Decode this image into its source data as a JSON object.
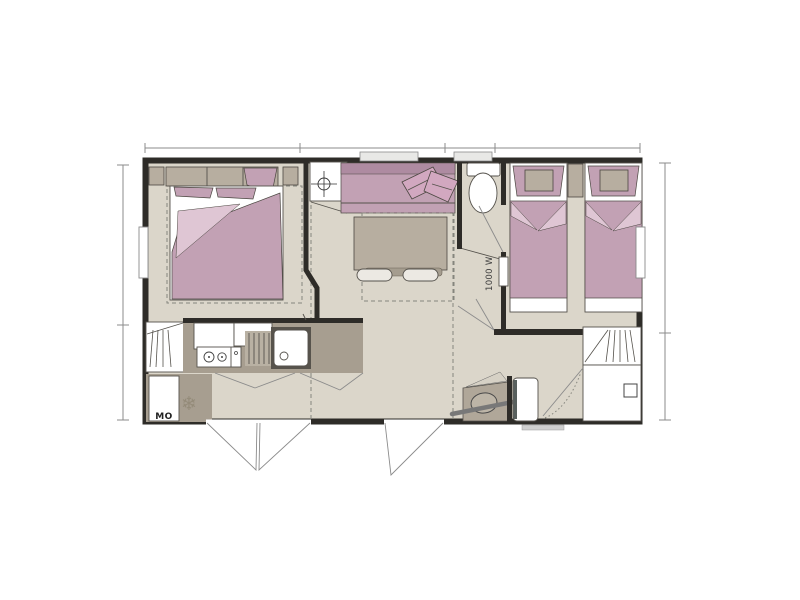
{
  "plan": {
    "type": "floor-plan",
    "labels": {
      "heater_power": "1000 W",
      "microwave": "MO"
    },
    "icons": {
      "snowflake": "❄"
    },
    "colors": {
      "floor": "#DBD6CA",
      "wall": "#2E2C28",
      "mauve": "#C2A1B4",
      "mauve2": "#AE8BA1",
      "pink": "#DFC6D4",
      "pillow": "#D2A8C0",
      "taupe": "#B7AEA0",
      "counter": "#A79E90",
      "line": "#8B8B8B",
      "stroke": "#55524C"
    }
  }
}
